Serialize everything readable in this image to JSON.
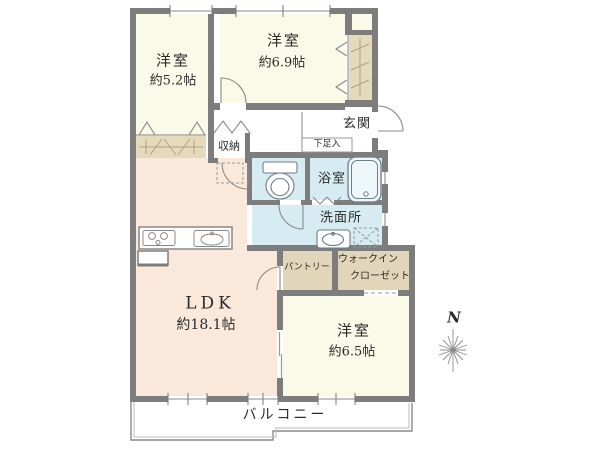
{
  "plan": {
    "rooms": {
      "bedroom_5_2": {
        "name": "洋室",
        "size": "約5.2帖"
      },
      "bedroom_6_9": {
        "name": "洋室",
        "size": "約6.9帖"
      },
      "bedroom_6_5": {
        "name": "洋室",
        "size": "約6.5帖"
      },
      "ldk": {
        "name": "LDK",
        "size": "約18.1帖"
      }
    },
    "areas": {
      "entrance": "玄関",
      "shoe_cabinet": "下足入",
      "storage": "収納",
      "bathroom": "浴室",
      "washroom": "洗面所",
      "pantry": "パントリー",
      "walk_in_closet_line1": "ウォークイン",
      "walk_in_closet_line2": "クローゼット",
      "balcony": "バルコニー"
    },
    "compass": {
      "north_label": "N"
    },
    "colors": {
      "wall": "#7d7d7d",
      "room_floor": "#fafae8",
      "ldk_floor": "#fae8da",
      "wet_area_floor": "#d7ecf2",
      "closet_floor": "#e2d6ba",
      "line": "#8a8a8a",
      "text": "#2b2b2b"
    }
  }
}
